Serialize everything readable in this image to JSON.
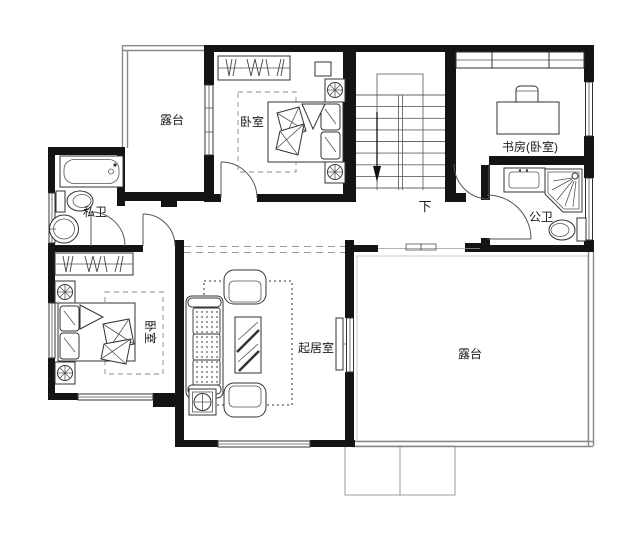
{
  "plan": {
    "type": "residential-floor-plan",
    "labels": {
      "terrace_top_left": "露台",
      "bedroom_top": "卧室",
      "study": "书房(卧室)",
      "private_bath": "私卫",
      "public_bath": "公卫",
      "bedroom_bottom_left": "卧室",
      "living_room": "起居室",
      "terrace_bottom_right": "露台",
      "stairs_down": "下"
    },
    "colors": {
      "wall": "#141414",
      "line": "#333333",
      "parapet": "#888888",
      "background": "#ffffff"
    }
  }
}
